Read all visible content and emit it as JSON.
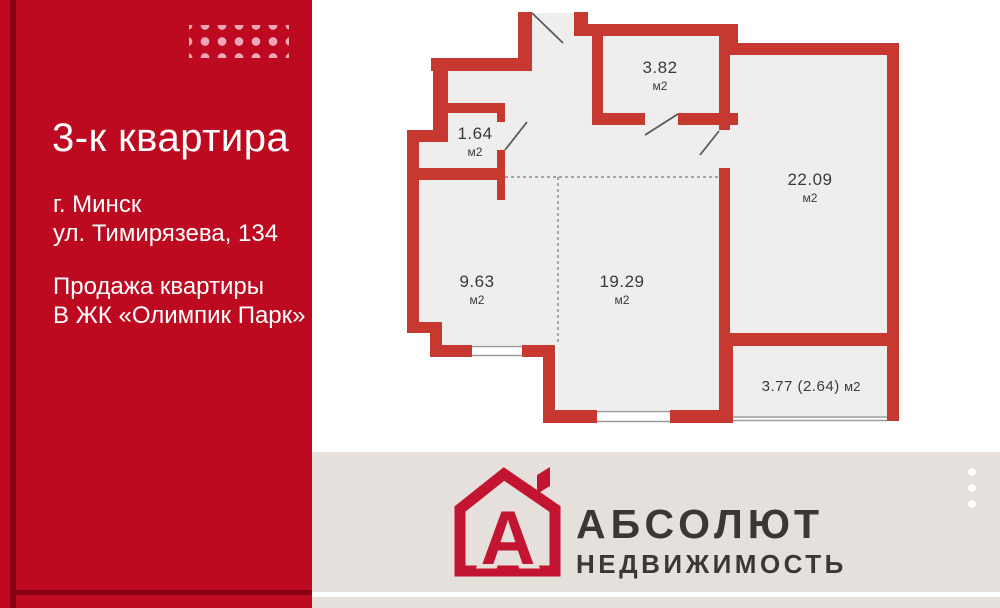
{
  "colors": {
    "panel-red": "#BE0A21",
    "panel-dark": "#8A0013",
    "panel-dots": "#F0A6B4",
    "wall": "#C63830",
    "floor": "#F0EEEC",
    "plan-line": "#5A5A5A",
    "dash-line": "#888888",
    "window-line": "#9A9A9A",
    "label-text": "#3A3A3A",
    "beige": "#E5E0DB",
    "brand-text": "#3B3734",
    "logo-red": "#C31431"
  },
  "panel": {
    "title": "3-к квартира",
    "city": "г. Минск",
    "street": "ул. Тимирязева, 134",
    "offer_line1": "Продажа квартиры",
    "offer_line2": "В ЖК «Олимпик Парк»"
  },
  "plan": {
    "rooms": [
      {
        "id": "room-1-64",
        "area": "1.64",
        "unit": "м2"
      },
      {
        "id": "room-3-82",
        "area": "3.82",
        "unit": "м2"
      },
      {
        "id": "room-22-09",
        "area": "22.09",
        "unit": "м2"
      },
      {
        "id": "room-9-63",
        "area": "9.63",
        "unit": "м2"
      },
      {
        "id": "room-19-29",
        "area": "19.29",
        "unit": "м2"
      },
      {
        "id": "balcony",
        "area": "3.77 (2.64)",
        "unit": "м2"
      }
    ]
  },
  "footer": {
    "logo_letter": "А",
    "brand_name": "АБСОЛЮТ",
    "brand_subtitle": "НЕДВИЖИМОСТЬ"
  }
}
